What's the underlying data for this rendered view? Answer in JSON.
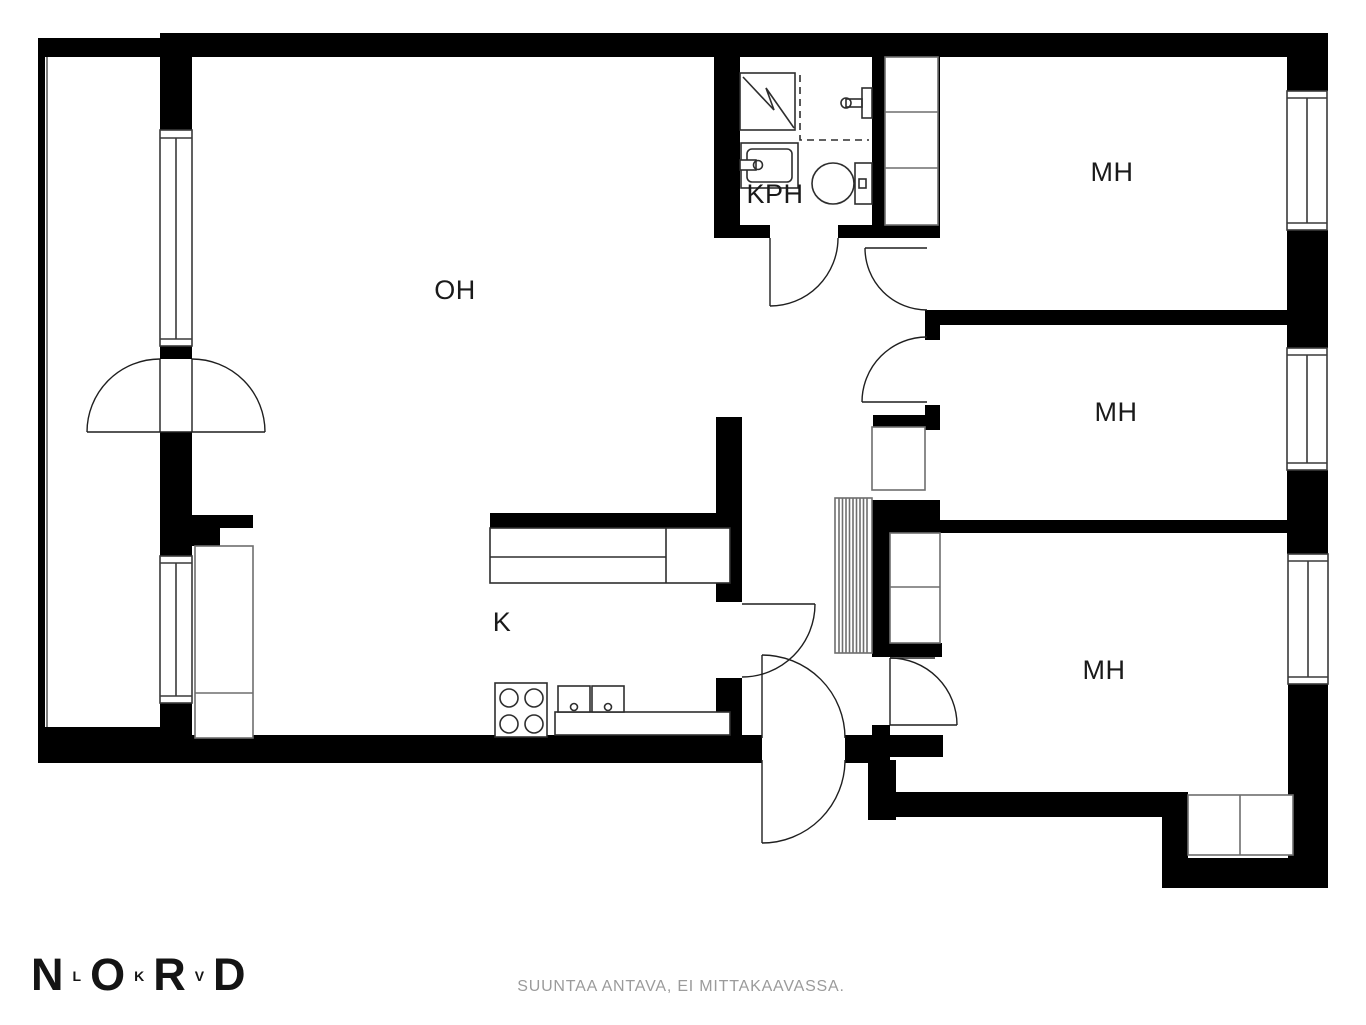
{
  "plan": {
    "type": "apartment-floorplan",
    "rooms": [
      {
        "id": "living-room",
        "label": "OH"
      },
      {
        "id": "kitchen",
        "label": "K"
      },
      {
        "id": "bathroom",
        "label": "KPH"
      },
      {
        "id": "bedroom-top",
        "label": "MH"
      },
      {
        "id": "bedroom-middle",
        "label": "MH"
      },
      {
        "id": "bedroom-bottom",
        "label": "MH"
      }
    ]
  },
  "colors": {
    "wall": "#000000",
    "fixture_line": "#3a3a3a",
    "closet_line": "#6e6e6e",
    "label": "#1a1a1a",
    "disclaimer": "#9b9b9b"
  },
  "footer": {
    "logo": {
      "letters": [
        {
          "char": "N",
          "size": "large"
        },
        {
          "char": "L",
          "size": "small"
        },
        {
          "char": "O",
          "size": "large"
        },
        {
          "char": "K",
          "size": "small"
        },
        {
          "char": "R",
          "size": "large"
        },
        {
          "char": "V",
          "size": "small"
        },
        {
          "char": "D",
          "size": "large"
        }
      ]
    },
    "disclaimer": "SUUNTAA ANTAVA, EI MITTAKAAVASSA."
  }
}
